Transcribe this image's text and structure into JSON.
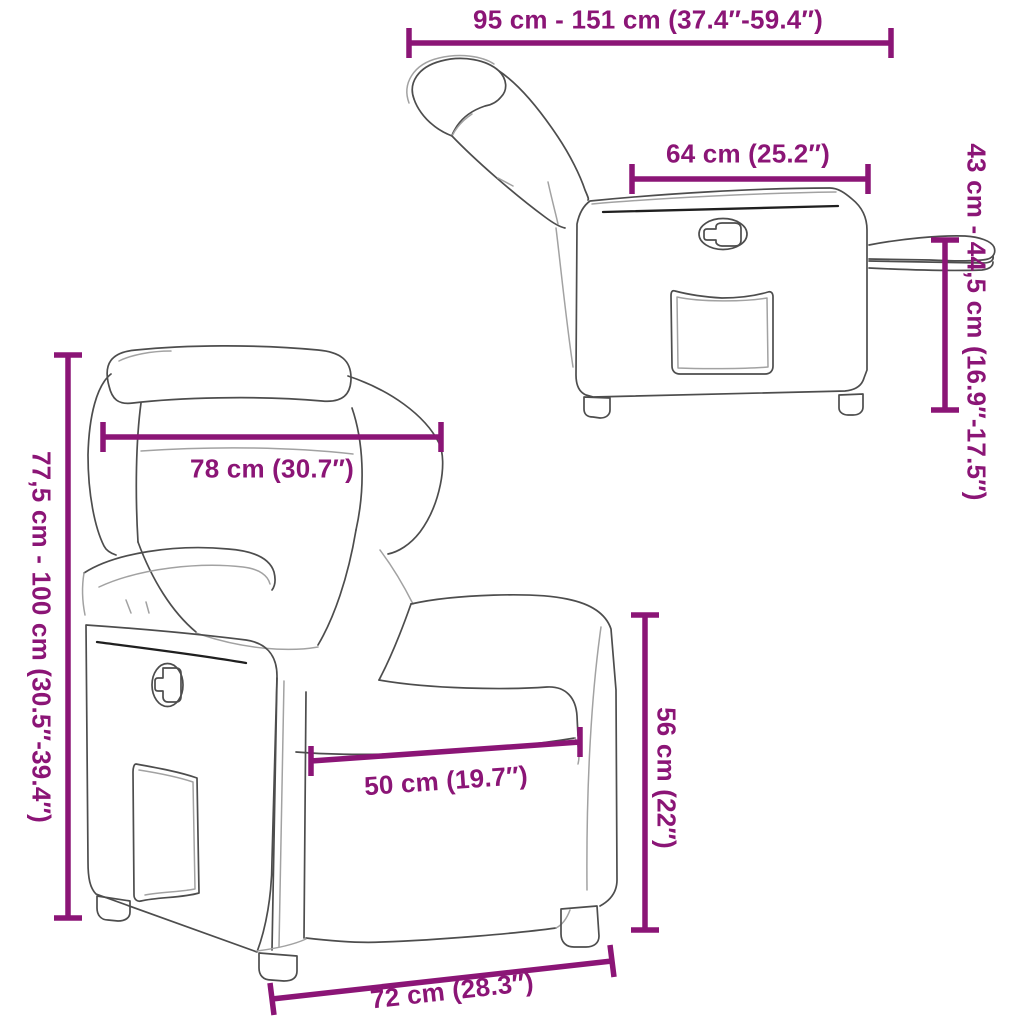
{
  "colors": {
    "accent": "#8B1576",
    "line_art": "#4d4d4d",
    "background": "#ffffff"
  },
  "diagram": {
    "views": {
      "side_view": "recliner-reclined-side-view",
      "front_view": "recliner-front-view"
    },
    "dimensions": {
      "overall_length": "95 cm - 151 cm (37.4″-59.4″)",
      "seat_unit_depth": "64 cm (25.2″)",
      "footrest_height": "43 cm - 44,5 cm (16.9″-17.5″)",
      "overall_height": "77,5 cm - 100 cm (30.5″-39.4″)",
      "back_width": "78 cm (30.7″)",
      "seat_width": "50 cm (19.7″)",
      "armrest_height": "56 cm (22″)",
      "base_width": "72 cm (28.3″)"
    }
  }
}
